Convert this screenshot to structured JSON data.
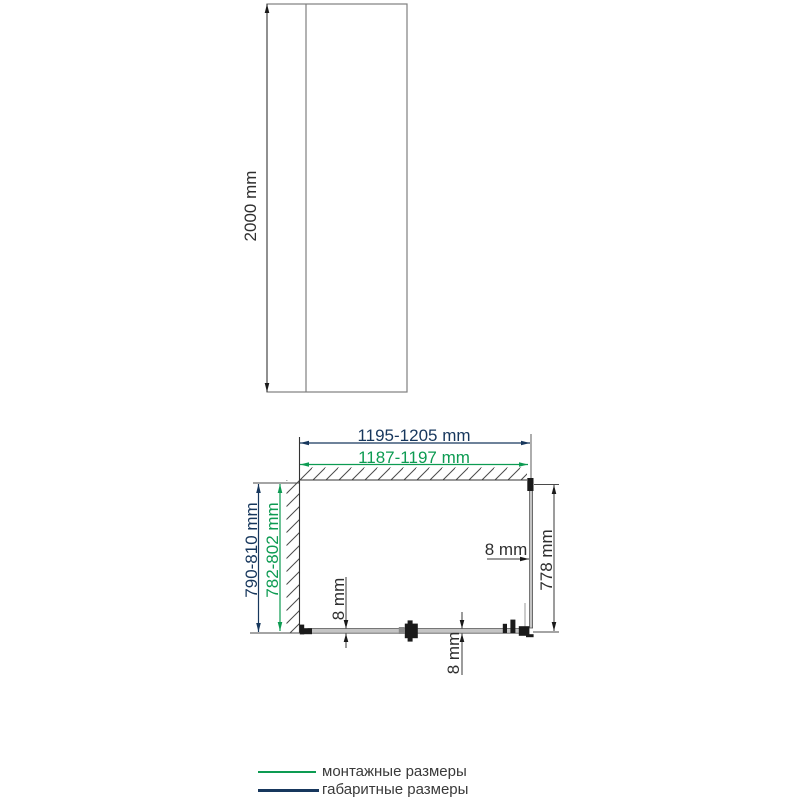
{
  "front_view": {
    "height_label": "2000 mm"
  },
  "plan_view": {
    "overall_width_label": "1195-1205 mm",
    "mounting_width_label": "1187-1197 mm",
    "overall_depth_label": "790-810 mm",
    "mounting_depth_label": "782-802 mm",
    "side_glass_width_label": "778 mm",
    "glass_thickness_right_label": "8 mm",
    "glass_thickness_side_label": "8 mm",
    "glass_thickness_door_label": "8 mm"
  },
  "legend": {
    "items": [
      {
        "id": "mounting",
        "label": "монтажные размеры",
        "color": "#0d9b52"
      },
      {
        "id": "overall",
        "label": "габаритные размеры",
        "color": "#17375d"
      }
    ]
  },
  "colors": {
    "overall_navy": "#17375d",
    "mounting_green": "#0d9b52",
    "drawing_gray": "#7f7f7f",
    "dim_black": "#2f2f2f",
    "text_dark": "#3a3a3a"
  }
}
